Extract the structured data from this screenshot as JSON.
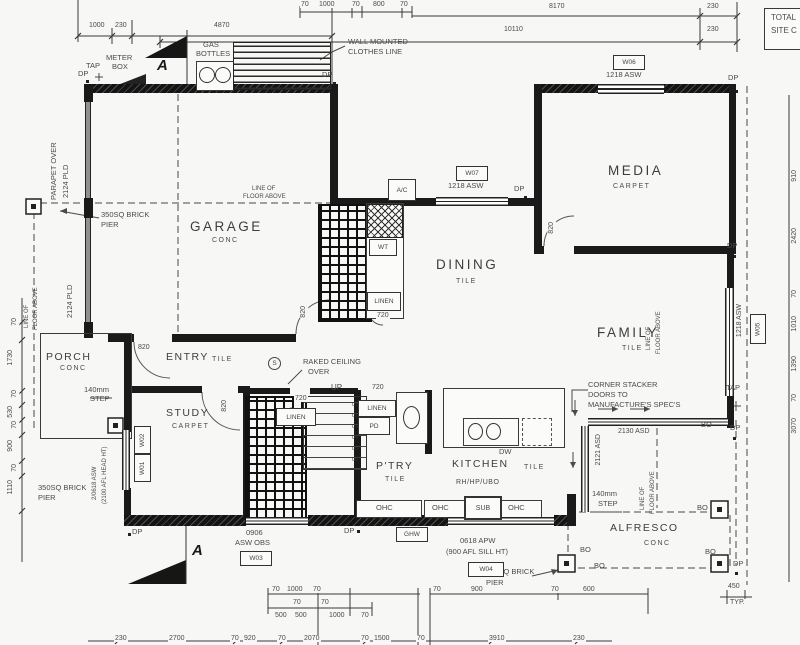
{
  "header": {
    "total_l1": "TOTAL",
    "total_l2": "SITE C"
  },
  "rooms": {
    "garage": {
      "name": "GARAGE",
      "sub": "CONC"
    },
    "porch": {
      "name": "PORCH",
      "sub": "CONC"
    },
    "entry": {
      "name": "ENTRY",
      "sub": "TILE"
    },
    "study": {
      "name": "STUDY",
      "sub": "CARPET"
    },
    "dining": {
      "name": "DINING",
      "sub": "TILE"
    },
    "media": {
      "name": "MEDIA",
      "sub": "CARPET"
    },
    "family": {
      "name": "FAMILY",
      "sub": "TILE"
    },
    "pantry": {
      "name": "P'TRY",
      "sub": "TILE"
    },
    "kitchen": {
      "name": "KITCHEN",
      "sub": "TILE",
      "extra": "RH/HP/UBO"
    },
    "alfresco": {
      "name": "ALFRESCO",
      "sub": "CONC"
    }
  },
  "stairs": {
    "up": "UP",
    "treads": [
      "01",
      "02",
      "03",
      "04",
      "05",
      "06"
    ]
  },
  "windows": {
    "w01": "W01",
    "w02": "W02",
    "w03": "W03",
    "w04": "W04",
    "w05": "W05",
    "w06": "W06",
    "w07": "W07",
    "asw1218": "1218 ASW",
    "w03_l1": "0906",
    "w03_l2": "ASW OBS",
    "w04_l1": "0618 APW",
    "w04_l2": "(900 AFL SILL HT)",
    "study_l1": "2/0618 ASW",
    "study_l2": "(2100 AFL HEAD HT)"
  },
  "doors": {
    "d820": "820",
    "d720": "720",
    "pld": "2124 PLD",
    "stacker_h": "2130 ASD",
    "stacker_v": "2121 ASD",
    "stacker_l1": "CORNER STACKER",
    "stacker_l2": "DOORS TO",
    "stacker_l3": "MANUFACTURE'S SPEC'S"
  },
  "fixtures": {
    "ac": "A/C",
    "wt": "WT",
    "linen": "LINEN",
    "pd": "PD",
    "dw": "DW",
    "ohc": "OHC",
    "sub": "SUB",
    "ghw": "GHW",
    "rhhpubo": "RH/HP/UBO",
    "gas_l1": "GAS",
    "gas_l2": "BOTTLES",
    "meter_l1": "METER",
    "meter_l2": "BOX"
  },
  "site": {
    "dp": "DP",
    "tap": "TAP",
    "bo": "BO",
    "s": "S",
    "section": "A",
    "clothes_l1": "WALL MOUNTED",
    "clothes_l2": "CLOTHES LINE",
    "pier_l1": "350SQ BRICK",
    "pier_l2": "PIER",
    "parapet_l1": "PARAPET OVER",
    "parapet_l2": "2124 PLD",
    "pld2": "2124 PLD",
    "lofa_l1": "LINE OF",
    "lofa_l2": "FLOOR ABOVE",
    "raked_l1": "RAKED CEILING",
    "raked_l2": "OVER",
    "step_l1": "140mm",
    "step_l2": "STEP",
    "typ_l1": "450",
    "typ_l2": "TYP."
  },
  "dims": {
    "top": [
      "1000",
      "230",
      "4870",
      "70",
      "1000",
      "70",
      "800",
      "70",
      "8170",
      "230",
      "10110",
      "230"
    ],
    "left": [
      "70",
      "1730",
      "70",
      "530",
      "70",
      "900",
      "70",
      "1110"
    ],
    "right": [
      "910",
      "2420",
      "70",
      "1010",
      "1390",
      "70",
      "3070"
    ],
    "bottom_a": [
      "70",
      "1000",
      "70",
      "70",
      "900",
      "70",
      "600"
    ],
    "bottom_b": [
      "70",
      "500",
      "500",
      "70",
      "1000",
      "70"
    ],
    "bottom_c": [
      "230",
      "2700",
      "70",
      "920",
      "70",
      "2070",
      "70",
      "1500",
      "70",
      "3910",
      "230"
    ]
  }
}
